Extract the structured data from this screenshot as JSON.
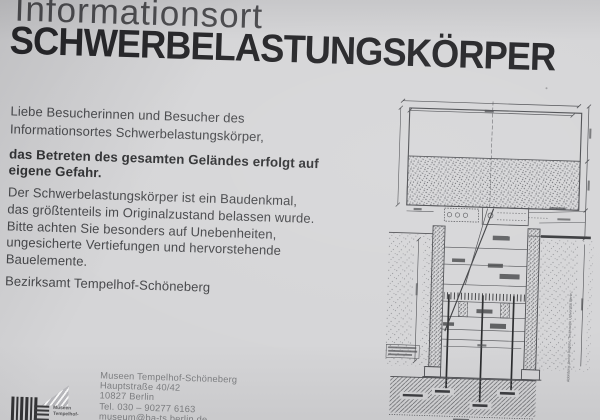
{
  "sign": {
    "kicker": "Informationsort",
    "title": "SCHWERBELASTUNGSKÖRPER",
    "intro_lines": [
      "Liebe Besucherinnen und Besucher des",
      "Informationsortes Schwerbelastungskörper,"
    ],
    "warning_lines": [
      "das Betreten des gesamten Geländes erfolgt auf",
      "eigene Gefahr."
    ],
    "notice_lines": [
      "Der Schwerbelastungskörper ist ein Baudenkmal,",
      "das größtenteils im Originalzustand belassen wurde.",
      "Bitte achten Sie besonders auf Unebenheiten,",
      "ungesicherte Vertiefungen und hervorstehende",
      "Bauelemente."
    ],
    "signature": "Bezirksamt Tempelhof-Schöneberg"
  },
  "footer": {
    "contact_lines": [
      "Museen Tempelhof-Schöneberg",
      "Hauptstraße 40/42",
      "10827 Berlin",
      "Tel. 030 – 90277 6163",
      "museum@ba-ts.berlin.de",
      "museen-tempelhof-schoeneberg.de"
    ],
    "logo_lines": [
      "Museen",
      "Tempelhof-"
    ]
  },
  "diagram": {
    "caption_vertical": "Abbildung: Archiv Degebo, Technische Universität Berlin"
  },
  "colors": {
    "sign_bg": "#d5d5d7",
    "title": "#232326",
    "kicker": "#4a4a4d",
    "body": "#454649",
    "bold": "#2e2f31",
    "contact": "#7f8083",
    "line": "#4a4b4f"
  }
}
